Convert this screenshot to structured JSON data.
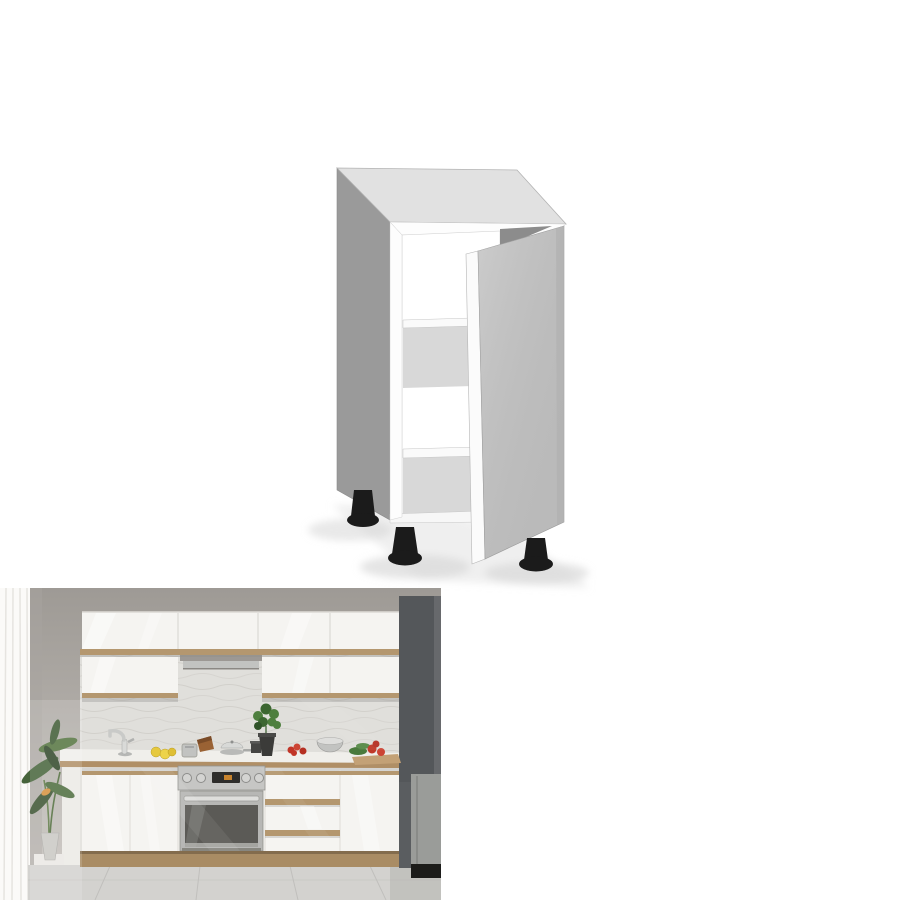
{
  "page": {
    "background": "#ffffff",
    "label": "Product listing image montage: white base kitchen cabinet"
  },
  "product_render": {
    "label": "3D render of a white base cabinet with one open door, two shelves and three black adjustable feet",
    "colors": {
      "top_face": "#e1e1e1",
      "side_panel": "#9a9a9a",
      "frame_white": "#fdfdfd",
      "interior": "#ffffff",
      "shelf_band": "#d8d8d8",
      "shadow_wedge": "#8c8c8c",
      "door_face": "#c4c4c4",
      "door_edge": "#fbfbfb",
      "foot": "#1b1b1b"
    }
  },
  "kitchen_photo": {
    "label": "Modern kitchen scene with white gloss cabinets, wood trim, built-in oven, tall dark grey unit with fridge, plant, tiled splashback and tiled floor",
    "colors": {
      "cabinet_white": "#f5f4f1",
      "wood_trim": "#b4976f",
      "tile": "#e0dfdb",
      "worktop": "#f0efeb",
      "curtain": "#fbfaf8",
      "dark_unit": "#54575a",
      "fridge": "#9a9c99",
      "fridge_base": "#1c1c1a",
      "oven_steel": "#c6c6c4",
      "oven_glass": "#5b5a56",
      "plinth": "#a98c64",
      "floor": "#d3d2cf",
      "plant_green": "#46633a",
      "lemon_yellow": "#e6c93f",
      "tomato_red": "#c13527",
      "steel": "#c2c3c1",
      "pot_dark": "#3b3b39",
      "hood_shadow": "#8f8c87"
    }
  }
}
